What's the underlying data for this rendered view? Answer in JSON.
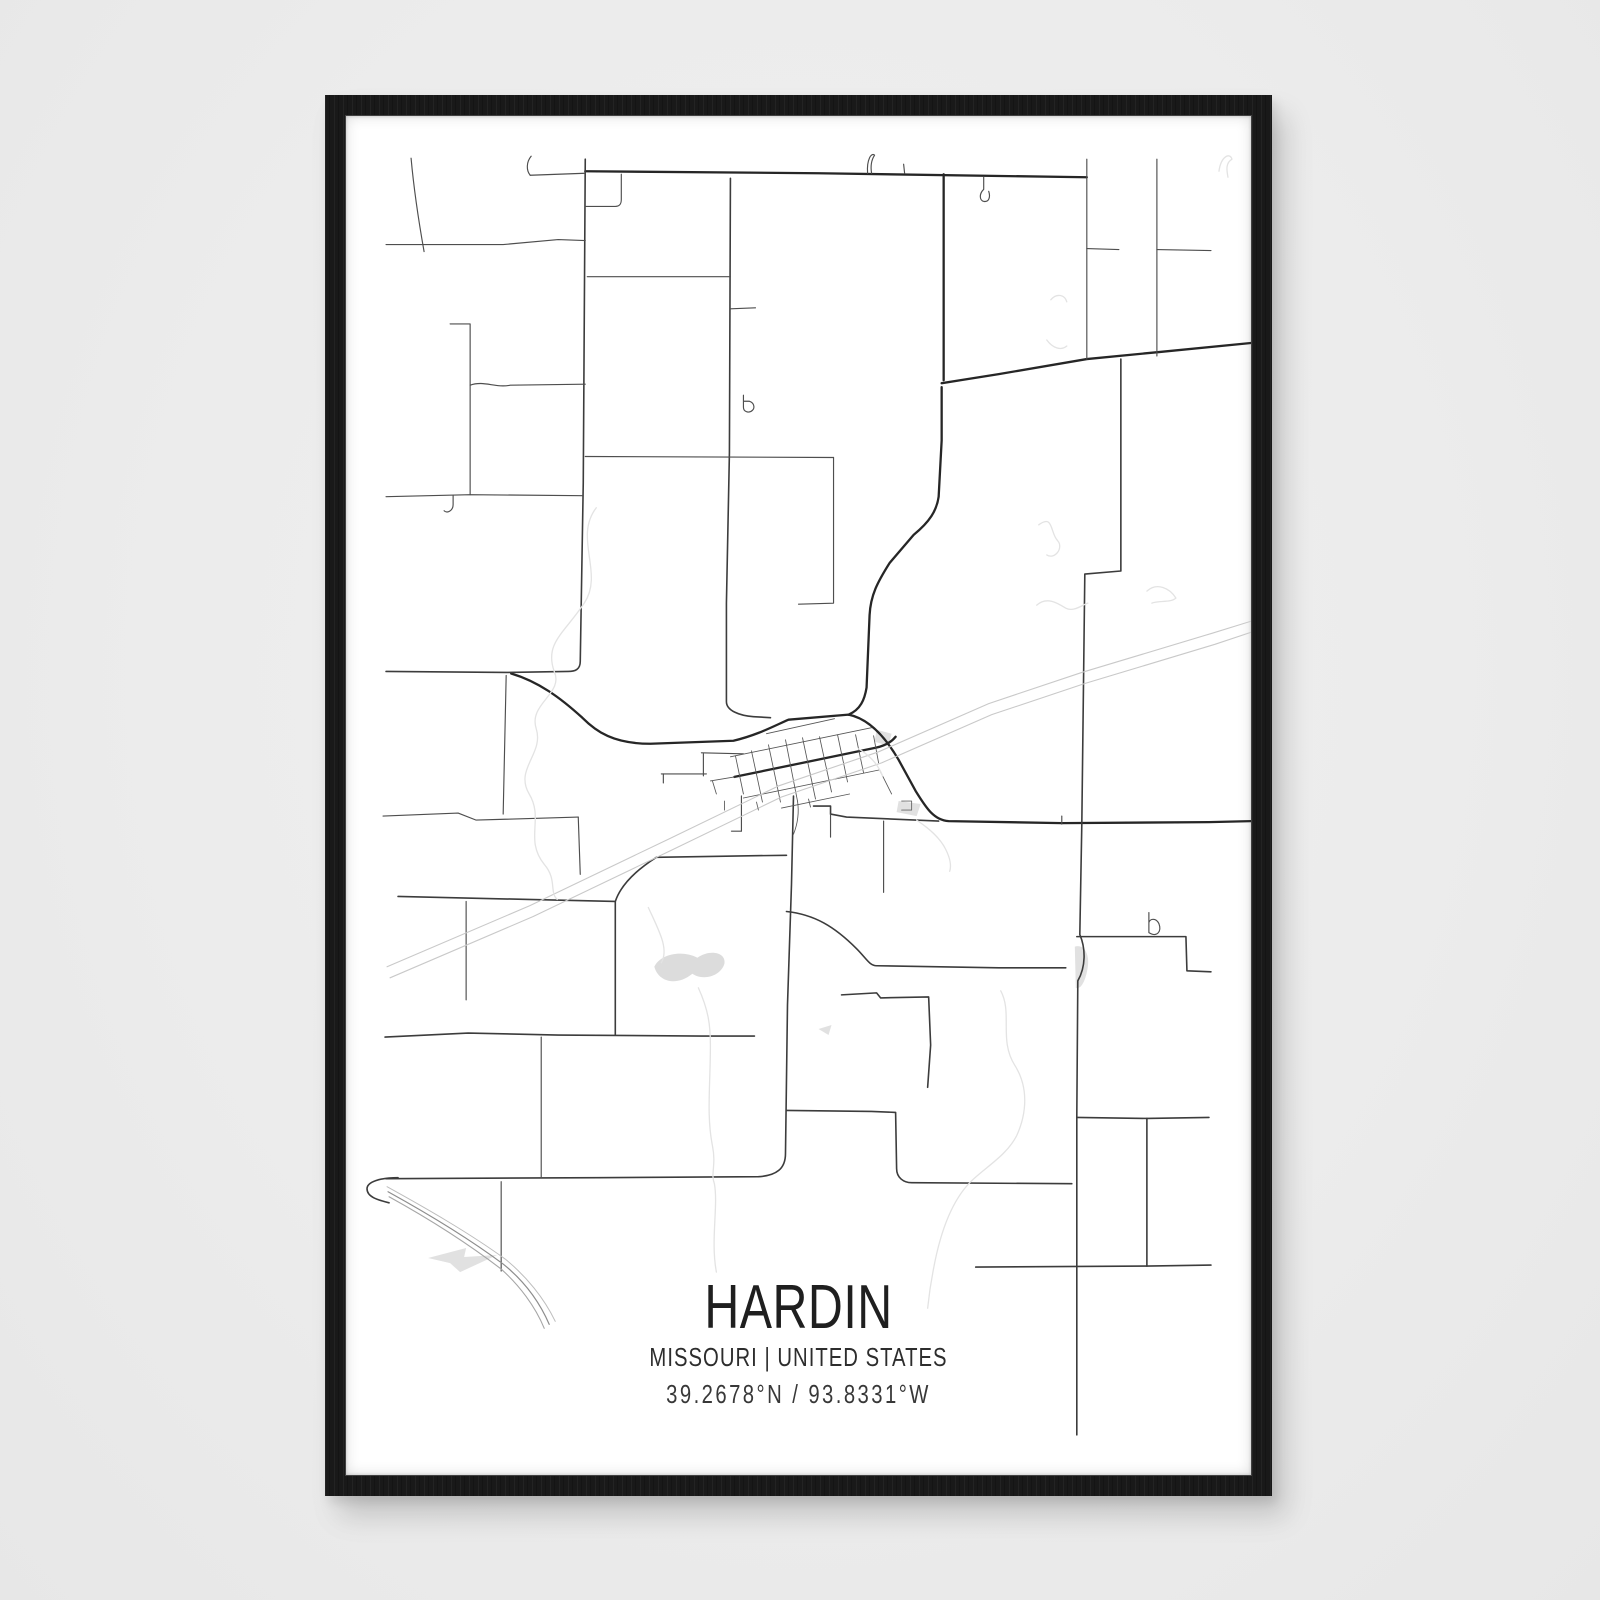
{
  "poster": {
    "title": "HARDIN",
    "subtitle": "MISSOURI | UNITED STATES",
    "coordinates": "39.2678°N / 93.8331°W"
  },
  "frame": {
    "frame_color": "#191919",
    "wall_color": "#ededed",
    "paper_color": "#ffffff"
  },
  "map": {
    "styles": {
      "m": {
        "w": 2.3,
        "c": "#262626"
      },
      "m2": {
        "w": 1.6,
        "c": "#3c3c3c"
      },
      "r": {
        "w": 1.15,
        "c": "#4e4e4e"
      },
      "t": {
        "w": 0.9,
        "c": "#666666"
      },
      "g": {
        "w": 0.85,
        "c": "#565656"
      },
      "rail": {
        "w": 1.1,
        "c": "#c9c9c9"
      },
      "b1": {
        "w": 1.2,
        "c": "#8d8d8d"
      },
      "b2": {
        "w": 1.1,
        "c": "#a6a6a6"
      },
      "b3": {
        "w": 1.0,
        "c": "#bdbdbd"
      },
      "f": {
        "w": 1.3,
        "c": "#e3e3e3"
      }
    },
    "fill_colors": {
      "lake": "#dcdcdc",
      "shade": "#e1e1e1"
    },
    "roads": [
      [
        "m",
        "M587,170 L820,172 L1088,176"
      ],
      [
        "m",
        "M513,670 C540,678 562,694 584,714 C598,728 615,740 652,740 L735,737 C760,731 776,722 790,716 L850,711 C870,715 886,732 900,756 L917,787 C926,801 934,816 950,817 L1063,819 L1210,818 L1252,817"
      ],
      [
        "m",
        "M850,711 C862,706 866,696 868,684 L871,612 C872,592 879,579 891,560 L915,532 C931,519 938,508 940,494 L943,438 L943,385"
      ],
      [
        "m",
        "M945,173 L945,378"
      ],
      [
        "m",
        "M943,381 L1000,372 L1088,357 L1160,350 L1252,341"
      ],
      [
        "m",
        "M736,773 L877,744 C887,742 893,738 897,733"
      ],
      [
        "m2",
        "M388,1173 L600,1172 L760,1171 C778,1170 787,1163 787,1148 L789,1000 L793,880 L795,792"
      ],
      [
        "m2",
        "M400,1172 C382,1172 369,1176 369,1183 C369,1191 379,1194 391,1197"
      ],
      [
        "m2",
        "M1122,357 L1122,568 L1086,571 L1083,820 L1081,930 C1087,944 1087,962 1079,976 L1078,1110 L1078,1428"
      ],
      [
        "m2",
        "M1078,932 L1187,932 L1188,966 L1212,967"
      ],
      [
        "m2",
        "M788,907 C816,910 836,922 858,944 C868,954 871,961 878,961 L1000,963 L1067,963"
      ],
      [
        "m2",
        "M732,177 L731,450 L728,600 L728,698 C728,707 741,712 755,713 L772,714"
      ],
      [
        "m2",
        "M587,158 L585,480 L582,658 C582,666 577,668 570,668 L508,669 L388,668"
      ],
      [
        "m2",
        "M400,892 L530,895 L617,897 L617,1030"
      ],
      [
        "m2",
        "M617,897 C622,882 636,867 658,853 L720,852 L788,851"
      ],
      [
        "m2",
        "M387,1032 L470,1028 L560,1030 L703,1031 L756,1031"
      ],
      [
        "m2",
        "M815,802 L832,802 L832,810 L848,813 L940,817"
      ],
      [
        "m2",
        "M788,1105 L873,1106 L897,1107 L898,1163 C898,1172 905,1177 913,1177 L1073,1178"
      ],
      [
        "m2",
        "M1078,1112 L1148,1113 L1210,1112"
      ],
      [
        "m2",
        "M1148,1113 L1148,1260"
      ],
      [
        "m2",
        "M977,1261 L1148,1260 L1212,1259"
      ],
      [
        "m2",
        "M843,990 L878,988 L882,993 L930,992 L932,1040 L929,1082"
      ],
      [
        "r",
        "M532,174 L587,172"
      ],
      [
        "r",
        "M532,174 C528,169 528,161 533,155"
      ],
      [
        "r",
        "M388,243 L505,243 L560,238 L587,239"
      ],
      [
        "r",
        "M413,157 C416,190 421,222 426,250"
      ],
      [
        "r",
        "M587,205 L617,205 C622,205 623,202 623,198 L623,173"
      ],
      [
        "r",
        "M589,275 L732,275"
      ],
      [
        "r",
        "M587,454 L835,455"
      ],
      [
        "r",
        "M835,455 L835,600 L800,601"
      ],
      [
        "r",
        "M1088,158 L1088,357"
      ],
      [
        "r",
        "M1158,158 L1158,354"
      ],
      [
        "r",
        "M1088,247 L1120,248"
      ],
      [
        "r",
        "M1158,248 L1212,249"
      ],
      [
        "r",
        "M452,322 L472,322 L472,492"
      ],
      [
        "r",
        "M472,383 C486,378 497,386 512,383 L587,382"
      ],
      [
        "r",
        "M388,494 L472,492 L584,493"
      ],
      [
        "r",
        "M455,493 L455,502 C455,508 449,511 446,508"
      ],
      [
        "r",
        "M508,672 L505,810"
      ],
      [
        "r",
        "M385,812 L460,809 L478,816 L580,813"
      ],
      [
        "r",
        "M580,813 L582,870"
      ],
      [
        "r",
        "M468,897 L468,995"
      ],
      [
        "r",
        "M885,817 L885,888"
      ],
      [
        "r",
        "M832,810 L832,833"
      ],
      [
        "r",
        "M503,1176 L503,1265"
      ],
      [
        "r",
        "M543,1032 L543,1172"
      ],
      [
        "r",
        "M732,307 L757,306"
      ],
      [
        "r",
        "M745,393 L745,405 C745,410 751,411 754,408 C757,405 755,400 751,399 L745,399"
      ],
      [
        "r",
        "M869,172 C868,158 873,151 876,154 C872,160 872,166 873,172"
      ],
      [
        "r",
        "M905,163 L906,172"
      ],
      [
        "r",
        "M1063,812 L1063,820"
      ],
      [
        "r",
        "M663,770 L708,770"
      ],
      [
        "r",
        "M665,770 L665,779"
      ],
      [
        "r",
        "M733,827 L743,827"
      ],
      [
        "r",
        "M743,792 L743,827"
      ],
      [
        "r",
        "M703,749 L745,750"
      ],
      [
        "r",
        "M705,750 L705,772"
      ],
      [
        "r",
        "M1150,908 L1150,928 C1158,933 1163,927 1160,919 C1157,913 1151,914 1150,918"
      ],
      [
        "r",
        "M985,176 L985,188 C980,193 981,199 985,200 C990,201 992,196 990,190"
      ],
      [
        "g",
        "M737,752 L745,790"
      ],
      [
        "g",
        "M753,747 L764,798"
      ],
      [
        "g",
        "M770,741 L782,798"
      ],
      [
        "g",
        "M787,736 L799,797"
      ],
      [
        "g",
        "M804,734 L817,795"
      ],
      [
        "g",
        "M821,733 L833,788"
      ],
      [
        "g",
        "M839,731 L849,778"
      ],
      [
        "g",
        "M857,731 L865,769"
      ],
      [
        "g",
        "M875,732 L880,759"
      ],
      [
        "g",
        "M732,753 L873,724"
      ],
      [
        "g",
        "M768,730 L836,715"
      ],
      [
        "g",
        "M745,794 L881,766"
      ],
      [
        "g",
        "M783,804 L851,790"
      ],
      [
        "g",
        "M712,777 L736,773"
      ],
      [
        "g",
        "M714,777 L718,790"
      ],
      [
        "g",
        "M799,797 C801,810 799,820 795,830"
      ],
      [
        "g",
        "M881,766 L893,790"
      ],
      [
        "g",
        "M726,797 L726,806"
      ],
      [
        "g",
        "M810,795 L812,803"
      ],
      [
        "rail",
        "M389,962 L532,901 L670,835 L780,782 L880,748 L990,700 L1083,669 L1213,630 L1252,618"
      ],
      [
        "rail",
        "M392,973 L535,912 L673,846 L783,793 L883,759 L993,711 L1086,680 L1216,641 L1252,629"
      ],
      [
        "b1",
        "M390,1186 C430,1208 470,1232 505,1258 C525,1274 541,1295 551,1318"
      ],
      [
        "b2",
        "M391,1191 C431,1213 469,1237 503,1263 C521,1279 537,1300 546,1322"
      ],
      [
        "b3",
        "M389,1181 C429,1203 471,1227 507,1253 C528,1270 546,1292 557,1315"
      ],
      [
        "f",
        "M598,505 C575,535 606,570 586,600 C566,630 546,640 556,668 C566,690 530,700 538,725 C546,750 516,765 531,790 C546,815 526,835 546,860 C559,875 551,888 559,895"
      ],
      [
        "f",
        "M650,903 C660,925 671,944 663,958"
      ],
      [
        "f",
        "M700,983 C710,1005 712,1020 712,1040 C712,1080 708,1110 714,1140 C718,1160 712,1168 716,1178 C720,1200 712,1235 718,1266"
      ],
      [
        "f",
        "M1002,986 C1014,1008 1000,1035 1016,1060 C1030,1082 1028,1108 1018,1130 C1008,1150 986,1162 972,1176 C952,1196 941,1230 935,1262 C931,1282 930,1292 929,1302"
      ],
      [
        "f",
        "M1038,602 C1048,593 1059,600 1067,605 C1075,609 1083,602 1089,600"
      ],
      [
        "f",
        "M1148,588 C1158,579 1171,585 1177,595 C1171,600 1160,597 1153,600"
      ],
      [
        "f",
        "M1052,298 C1058,291 1066,293 1068,300"
      ],
      [
        "f",
        "M1048,338 C1054,346 1062,349 1068,344"
      ],
      [
        "f",
        "M1040,522 C1055,511 1051,530 1059,538 C1065,545 1056,557 1048,552"
      ],
      [
        "f",
        "M1220,170 C1222,155 1231,151 1233,158 C1226,162 1228,170 1229,176"
      ],
      [
        "f",
        "M918,816 C930,824 941,833 947,845 C951,853 953,861 951,867"
      ],
      [
        "f",
        "M860,745 C872,752 880,762 884,772"
      ],
      [
        "t",
        "M903,797 L913,797 L913,806 L903,806"
      ],
      [
        "t",
        "M758,798 L760,806"
      ]
    ],
    "water_fills": [
      [
        "lake",
        "M656,962 C662,949 684,945 699,953 C712,944 728,948 726,959 C722,972 704,976 694,969 C678,982 660,977 656,962 Z"
      ],
      [
        "shade",
        "M430,1252 L468,1242 L466,1251 L499,1249 L462,1266 L452,1257 Z"
      ],
      [
        "shade",
        "M878,726 L893,730 L890,742 L876,738 Z"
      ],
      [
        "shade",
        "M900,797 L922,800 L918,812 L898,808 Z"
      ],
      [
        "shade",
        "M1076,942 C1084,939 1091,948 1089,962 C1087,976 1082,985 1077,983 Z"
      ],
      [
        "shade",
        "M820,1024 L833,1020 L830,1030 Z"
      ]
    ]
  }
}
